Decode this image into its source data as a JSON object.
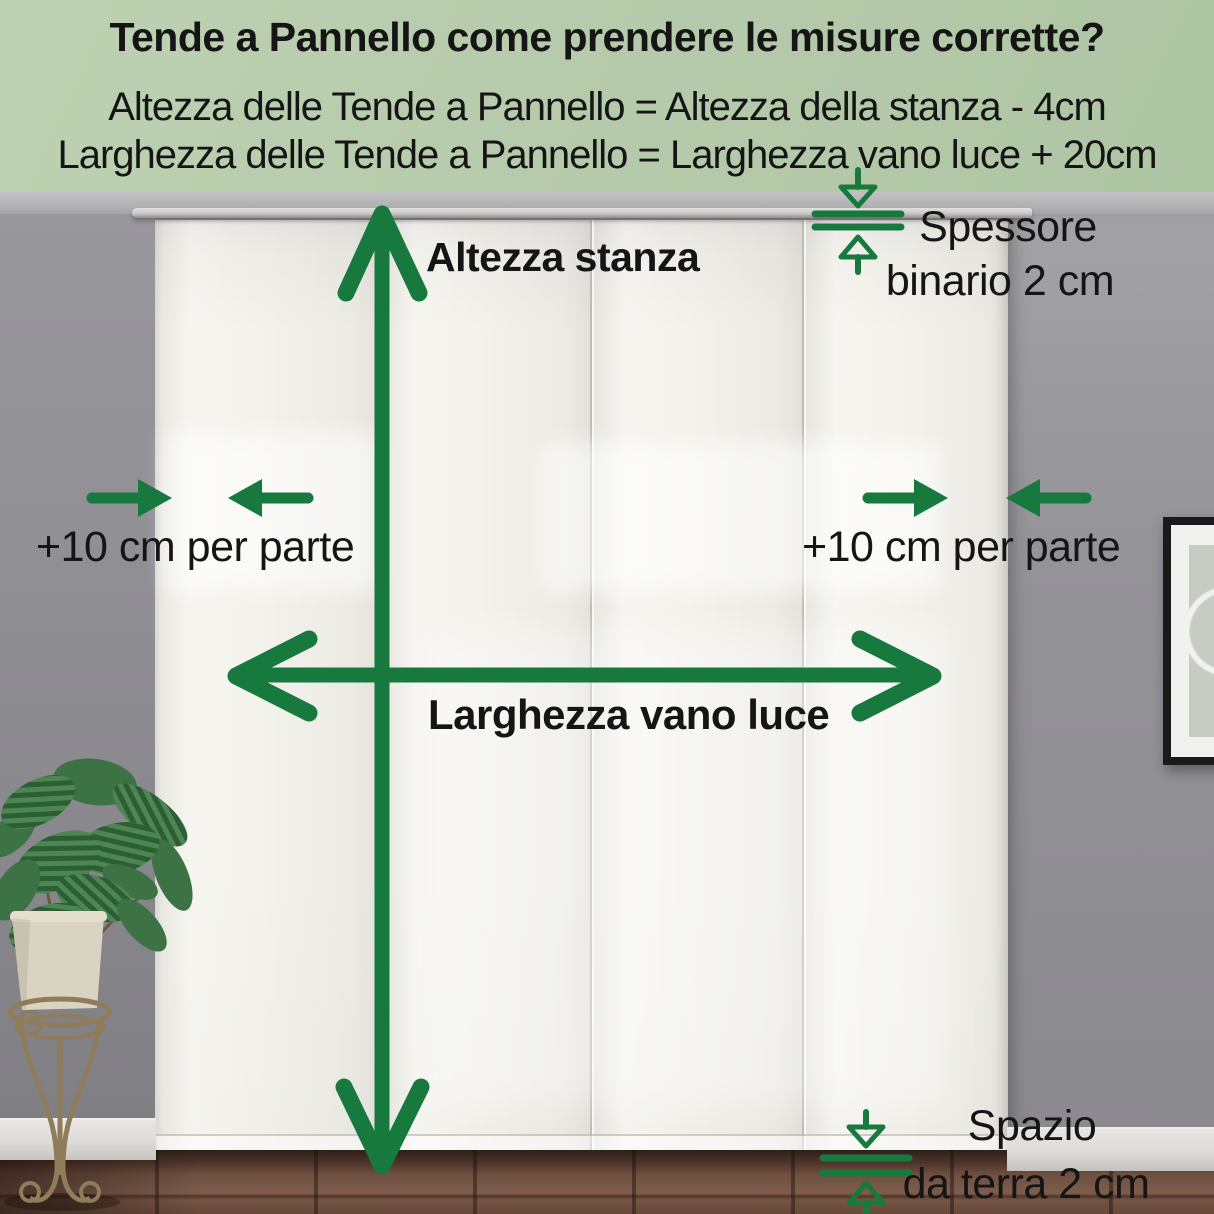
{
  "header": {
    "title": "Tende a Pannello come prendere le misure corrette?",
    "formula_height": "Altezza delle Tende a Pannello = Altezza della stanza - 4cm",
    "formula_width": "Larghezza delle Tende a Pannello = Larghezza vano luce + 20cm"
  },
  "annotations": {
    "room_height_label": "Altezza stanza",
    "opening_width_label": "Larghezza vano luce",
    "left_margin_label": "+10 cm per parte",
    "right_margin_label": "+10 cm per parte",
    "rail_label_line1": "Spessore",
    "rail_label_line2": "binario 2 cm",
    "floor_label_line1": "Spazio",
    "floor_label_line2": "da terra 2 cm"
  },
  "colors": {
    "accent": "#17793d",
    "header_bg": "#b6cbab",
    "text": "#151515",
    "wall": "#929197",
    "curtain": "#f3f2ec",
    "rail": "#c9c8c6",
    "floor": "#6e4f40",
    "baseboard": "#dcdbd7",
    "frame": "#1a1a1a",
    "pot": "#d9d4c1",
    "leaf_dark": "#2c5d34",
    "leaf_mid": "#3d7244",
    "leaf_light": "#4c8653",
    "stand": "#8f7c5a"
  }
}
